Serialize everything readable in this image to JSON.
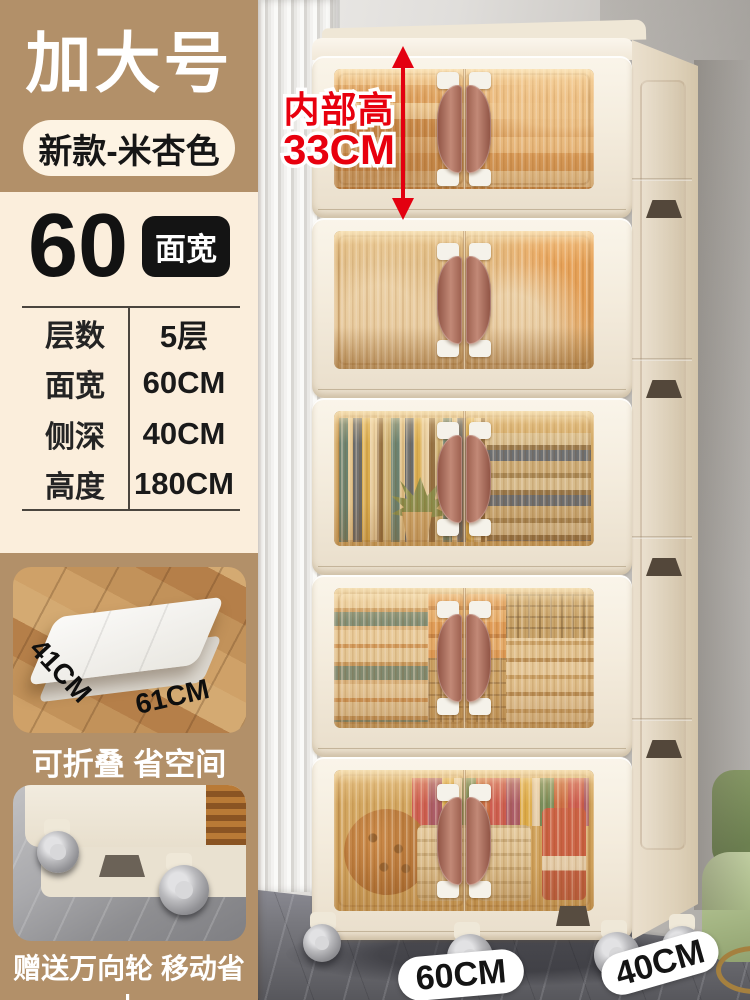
{
  "theme": {
    "tan": "#b29069",
    "cream_panel": "#fbeedc",
    "pill_cream": "#fdf3e3",
    "badge_black": "#141414",
    "accent_red": "#e8000e",
    "cabinet_cream": "#f3ebdc",
    "glass_amber": "#d8a055",
    "handle_brown": "#b5786a",
    "wall_gray": "#c9c6c2",
    "floor_gray": "#6e6e72",
    "chair_green": "#a9bb88"
  },
  "header": {
    "size_label": "加大号",
    "variant_label": "新款-米杏色"
  },
  "spec": {
    "width_number": "60",
    "width_badge": "面宽",
    "rows": [
      {
        "label": "层数",
        "value": "5层"
      },
      {
        "label": "面宽",
        "value": "60CM"
      },
      {
        "label": "侧深",
        "value": "40CM"
      },
      {
        "label": "高度",
        "value": "180CM"
      }
    ]
  },
  "features": [
    {
      "caption": "可折叠 省空间",
      "dim_depth": "41CM",
      "dim_width": "61CM"
    },
    {
      "caption": "赠送万向轮 移动省力"
    }
  ],
  "annotation": {
    "label": "内部高",
    "value": "33CM"
  },
  "floor_tags": {
    "front_width": "60CM",
    "side_depth": "40CM"
  }
}
